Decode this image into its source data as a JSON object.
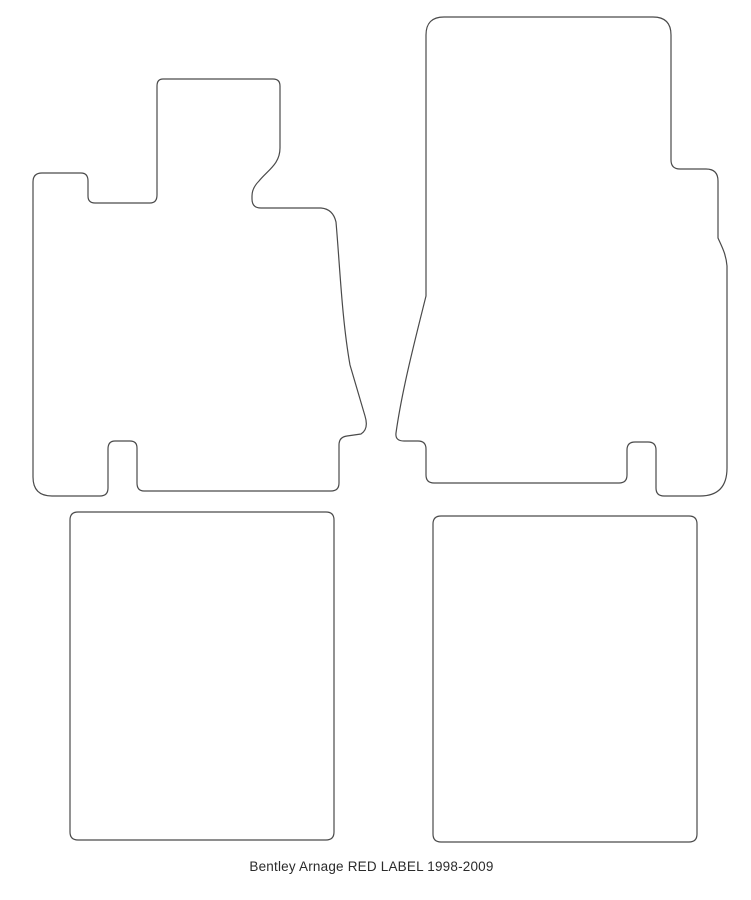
{
  "page": {
    "background": "#ffffff",
    "caption": "Bentley Arnage RED LABEL 1998-2009"
  },
  "drawing": {
    "stroke_color": "#4a4a4a",
    "fill_color": "#ffffff",
    "caption_color": "#2b2b2b",
    "mats": [
      {
        "name": "front-left-mat",
        "path": "M 163 79 L 273 79 Q 280 79 280 86 L 280 148 C 280 164 268 170 259 181 Q 252 188 252 196 L 252 199 Q 252 208 261 208 L 321 208 Q 333 209 336 222 C 340 268 342 320 350 365 L 365 416 Q 369 429 361 434 L 347 436 Q 339 437 339 445 L 339 483 Q 339 491 331 491 L 144 491 Q 137 491 137 483 L 137 448 Q 137 441 130 441 L 115 441 Q 108 441 108 449 L 108 488 Q 108 496 100 496 L 52 496 Q 33 496 33 477 L 33 182 Q 33 173 42 173 L 81 173 Q 88 173 88 181 L 88 196 Q 88 203 95 203 L 150 203 Q 157 203 157 195 L 157 86 Q 157 79 163 79 Z"
      },
      {
        "name": "front-right-mat",
        "path": "M 444 17 L 653 17 Q 671 17 671 35 L 671 160 Q 671 169 680 169 L 706 169 Q 718 169 718 181 L 718 238 C 722 247 726 254 727 266 L 727 468 Q 727 496 700 496 L 664 496 Q 656 496 656 488 L 656 450 Q 656 442 648 442 L 635 442 Q 627 442 627 450 L 627 475 Q 627 483 619 483 L 434 483 Q 426 483 426 475 L 426 449 Q 426 441 418 441 L 404 441 Q 395 441 396 433 C 402 390 415 340 426 296 L 426 35 Q 426 17 444 17 Z"
      },
      {
        "name": "rear-left-mat",
        "path": "M 78 512 L 326 512 Q 334 512 334 520 L 334 832 Q 334 840 326 840 L 78 840 Q 70 840 70 832 L 70 520 Q 70 512 78 512 Z"
      },
      {
        "name": "rear-right-mat",
        "path": "M 441 516 L 689 516 Q 697 516 697 524 L 697 834 Q 697 842 689 842 L 441 842 Q 433 842 433 834 L 433 524 Q 433 516 441 516 Z"
      }
    ]
  }
}
